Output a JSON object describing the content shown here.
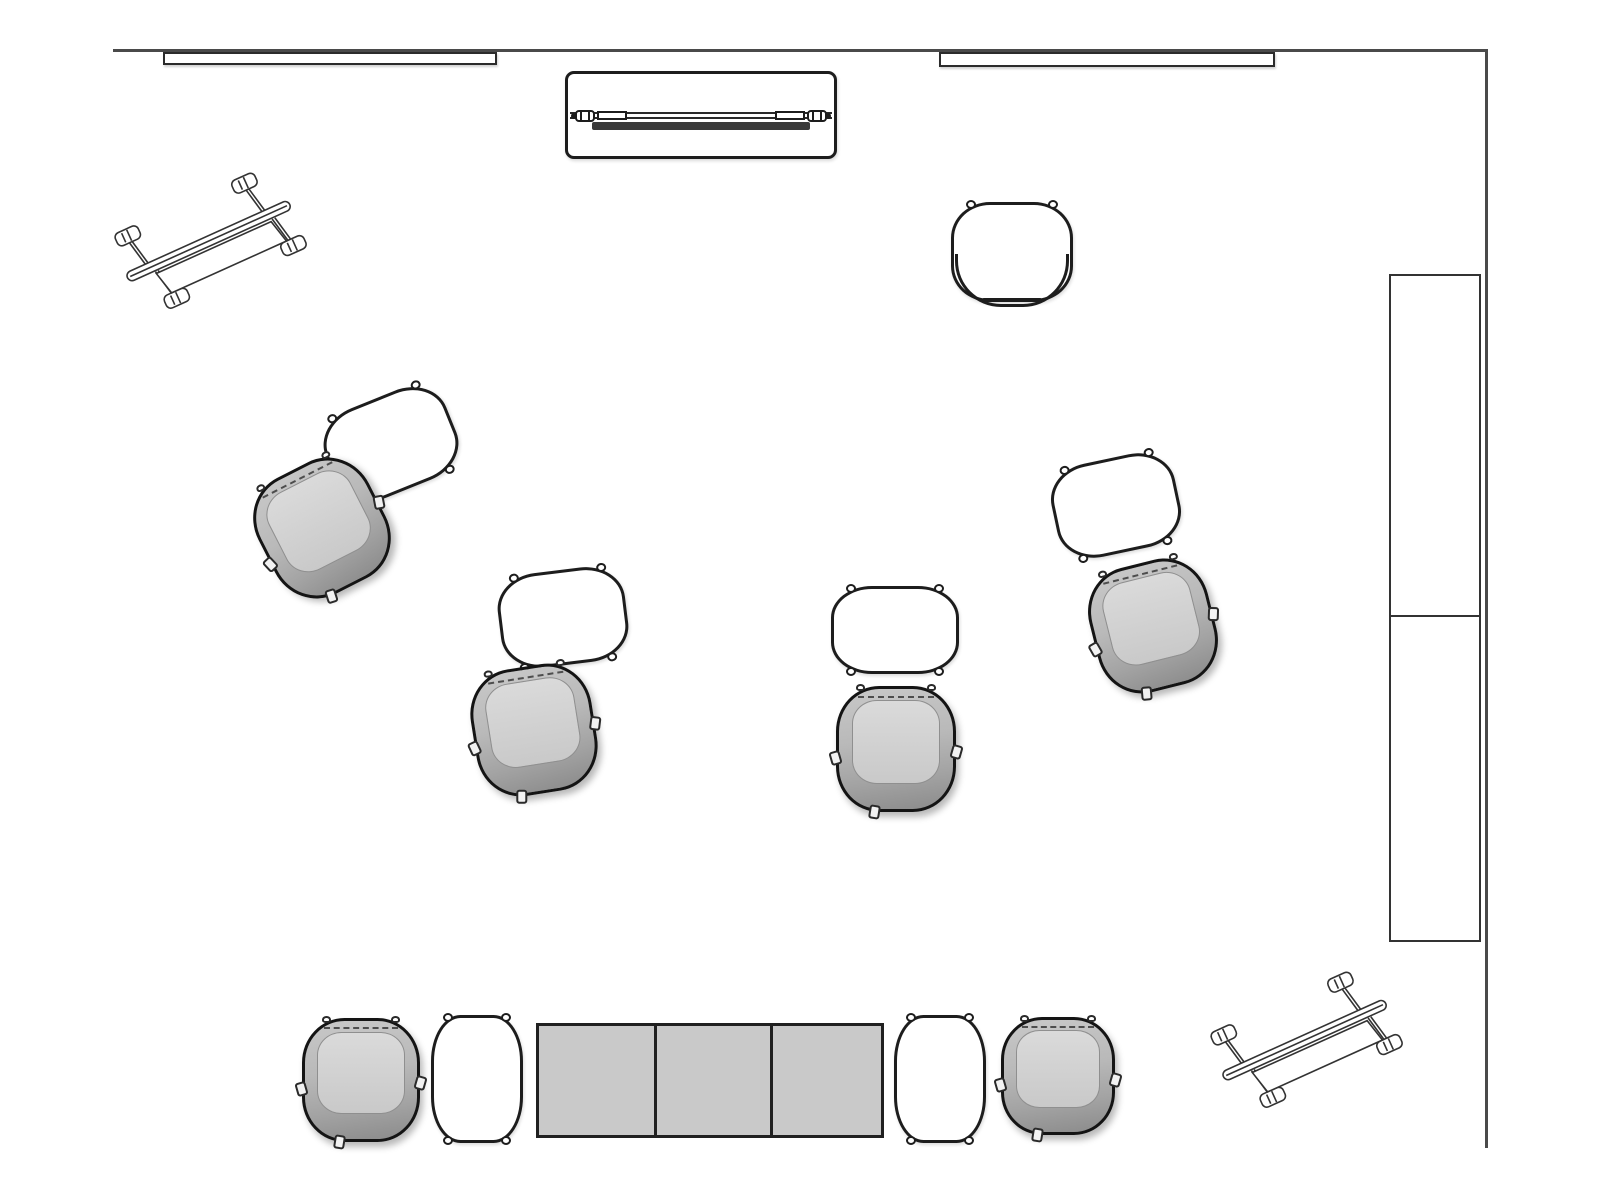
{
  "title": "meeting-space-floor-plan",
  "room": {
    "width": 1600,
    "height": 1200,
    "walls": [
      {
        "name": "wall-top",
        "x": 113,
        "y": 49,
        "w": 1374,
        "h": 3
      },
      {
        "name": "wall-right",
        "x": 1485,
        "y": 49,
        "w": 3,
        "h": 1099
      }
    ]
  },
  "colors": {
    "background": "#ffffff",
    "line": "#1d1d1d",
    "wall": "#4a4a4a",
    "chair_shell": "#a9a9a9",
    "chair_seat": "#d2d2d2",
    "table_fill": "#ffffff",
    "square_table_fill": "#c9c9c9",
    "media_bar": "#3a3a3a"
  },
  "furniture": [
    {
      "type": "wall_board",
      "name": "wall-board-left",
      "x": 163,
      "y": 52,
      "w": 334,
      "h": 13
    },
    {
      "type": "wall_board",
      "name": "wall-board-right",
      "x": 939,
      "y": 52,
      "w": 336,
      "h": 15
    },
    {
      "type": "credenza",
      "name": "media-credenza",
      "x": 565,
      "y": 71,
      "w": 272,
      "h": 88
    },
    {
      "type": "bench",
      "name": "bench-top-left",
      "x": 104,
      "y": 163,
      "w": 210,
      "h": 165,
      "angle": -24.3
    },
    {
      "type": "bench",
      "name": "bench-bottom-right",
      "x": 1200,
      "y": 962,
      "w": 210,
      "h": 165,
      "angle": -24.3
    },
    {
      "type": "table",
      "name": "occasional-table-top-right",
      "cx": 1012,
      "cy": 252,
      "w": 122,
      "h": 100,
      "r": 0,
      "rimmed": true
    },
    {
      "type": "table",
      "name": "occasional-table-1",
      "cx": 391,
      "cy": 444,
      "w": 130,
      "h": 96,
      "r": -22
    },
    {
      "type": "chair",
      "name": "lounge-chair-1",
      "cx": 322,
      "cy": 528,
      "w": 124,
      "h": 130,
      "r": -27
    },
    {
      "type": "table",
      "name": "occasional-table-2",
      "cx": 563,
      "cy": 617,
      "w": 128,
      "h": 95,
      "r": -7
    },
    {
      "type": "chair",
      "name": "lounge-chair-2",
      "cx": 534,
      "cy": 730,
      "w": 122,
      "h": 128,
      "r": -9
    },
    {
      "type": "table",
      "name": "occasional-table-3",
      "cx": 895,
      "cy": 630,
      "w": 128,
      "h": 88,
      "r": 0
    },
    {
      "type": "chair",
      "name": "lounge-chair-3",
      "cx": 896,
      "cy": 749,
      "w": 120,
      "h": 126,
      "r": 0
    },
    {
      "type": "table",
      "name": "occasional-table-4",
      "cx": 1116,
      "cy": 505,
      "w": 126,
      "h": 95,
      "r": -12
    },
    {
      "type": "chair",
      "name": "lounge-chair-4",
      "cx": 1153,
      "cy": 626,
      "w": 122,
      "h": 128,
      "r": -14
    },
    {
      "type": "chair",
      "name": "lounge-chair-5",
      "cx": 361,
      "cy": 1080,
      "w": 118,
      "h": 124,
      "r": 0
    },
    {
      "type": "table",
      "name": "occasional-table-5",
      "cx": 477,
      "cy": 1079,
      "w": 92,
      "h": 128,
      "r": 0
    },
    {
      "type": "square_tables",
      "name": "square-table-group",
      "x": 536,
      "y": 1023,
      "w": 348,
      "h": 115,
      "count": 3
    },
    {
      "type": "table",
      "name": "occasional-table-6",
      "cx": 940,
      "cy": 1079,
      "w": 92,
      "h": 128,
      "r": 0
    },
    {
      "type": "chair",
      "name": "lounge-chair-6",
      "cx": 1058,
      "cy": 1076,
      "w": 114,
      "h": 118,
      "r": 0
    },
    {
      "type": "storage",
      "name": "storage-wall-unit",
      "x": 1389,
      "y": 274,
      "w": 92,
      "h": 668,
      "divider_y": 613
    }
  ]
}
